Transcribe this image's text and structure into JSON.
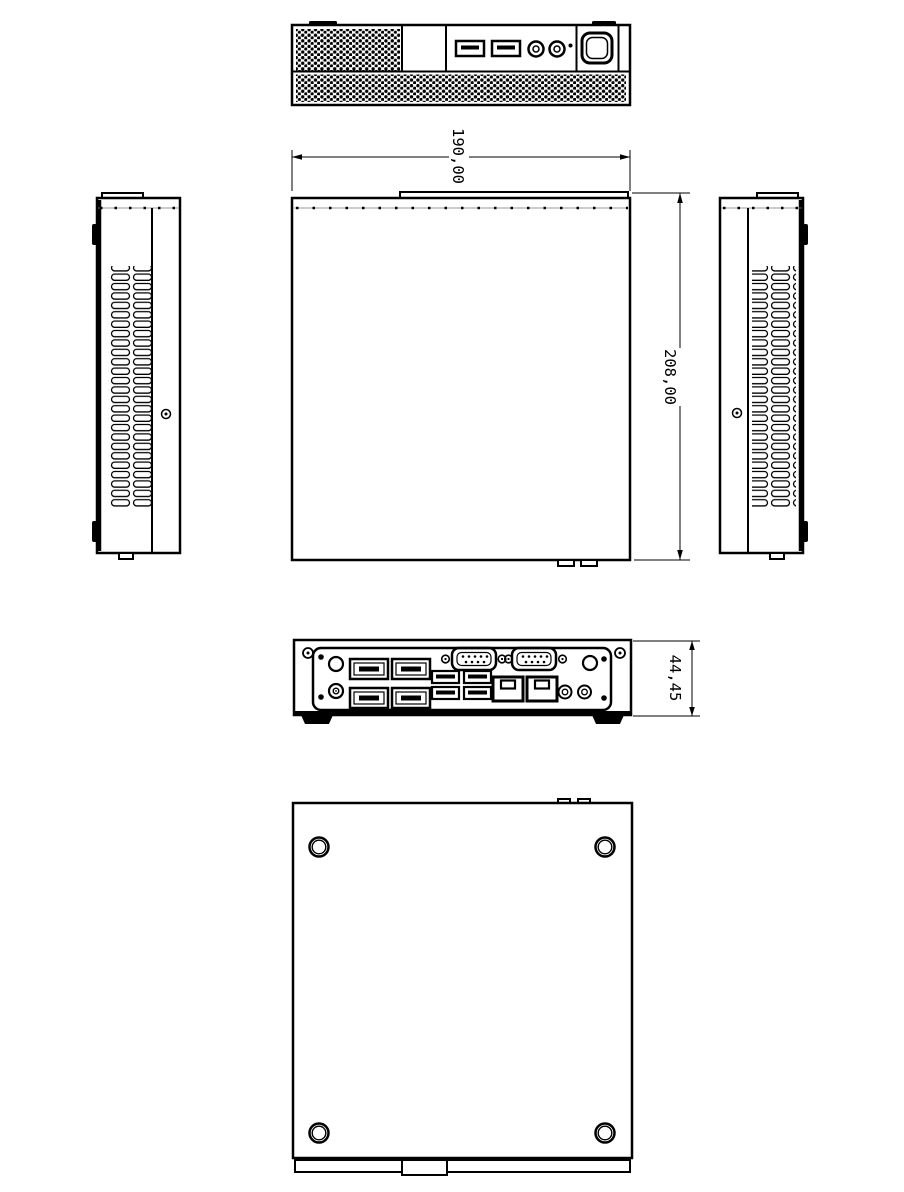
{
  "dimensions": {
    "width": "190,00",
    "depth": "208,00",
    "height": "44,45"
  },
  "colors": {
    "line": "#000000",
    "background": "#ffffff"
  },
  "views": {
    "front": {
      "ports": [
        "vent-grille",
        "blank-panel",
        "usb-port",
        "usb-port",
        "audio-jack",
        "audio-jack",
        "power-led",
        "power-button"
      ]
    },
    "top": {
      "features": [
        "chassis-outline",
        "front-edge-vents",
        "rear-tabs"
      ]
    },
    "left_side": {
      "features": [
        "vent-slots",
        "screw-hole",
        "mounting-feet"
      ]
    },
    "right_side": {
      "features": [
        "vent-slots",
        "screw-hole",
        "mounting-feet"
      ]
    },
    "rear": {
      "ports": [
        "antenna-hole",
        "dc-jack",
        "displayport",
        "displayport",
        "displayport",
        "displayport",
        "usb-port",
        "usb-port",
        "usb-port",
        "usb-port",
        "serial-db9",
        "serial-db9",
        "lan-rj45",
        "lan-rj45",
        "audio-jack",
        "audio-jack",
        "antenna-hole"
      ]
    },
    "bottom": {
      "features": [
        "rubber-foot",
        "rubber-foot",
        "rubber-foot",
        "rubber-foot",
        "rear-strip"
      ]
    }
  }
}
